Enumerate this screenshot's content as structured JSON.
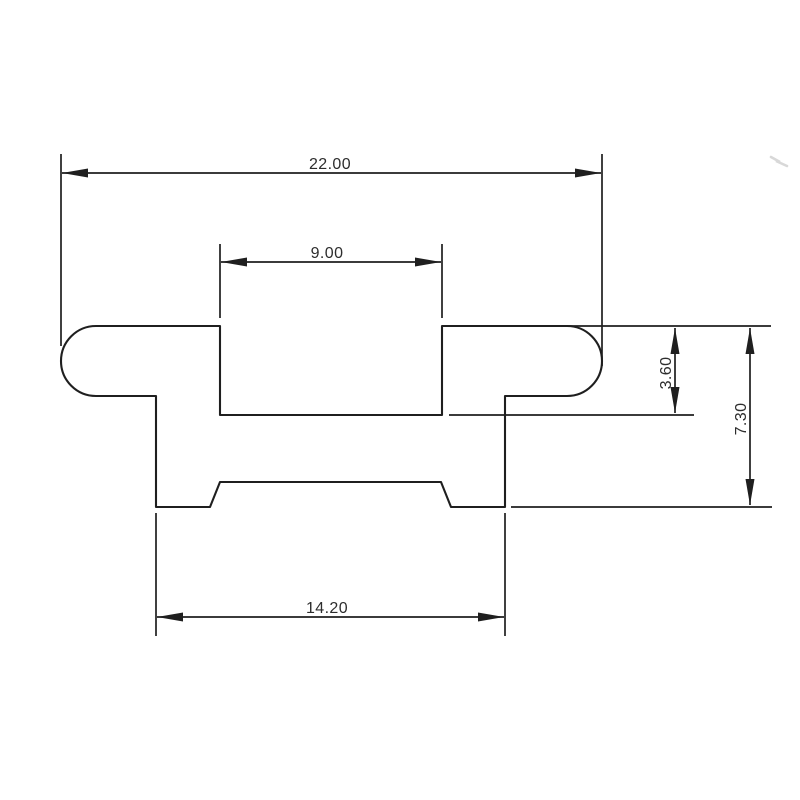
{
  "drawing": {
    "type": "technical-cross-section-drawing",
    "colors": {
      "background": "#ffffff",
      "line": "#1f1f1f",
      "text": "#2d2d2d"
    },
    "dimensions": {
      "overall_width": {
        "label": "22.00",
        "value": 22.0,
        "orientation": "horizontal"
      },
      "slot_width": {
        "label": "9.00",
        "value": 9.0,
        "orientation": "horizontal"
      },
      "slot_depth": {
        "label": "3.60",
        "value": 3.6,
        "orientation": "vertical"
      },
      "total_height": {
        "label": "7.30",
        "value": 7.3,
        "orientation": "vertical"
      },
      "base_width": {
        "label": "14.20",
        "value": 14.2,
        "orientation": "horizontal"
      }
    }
  }
}
